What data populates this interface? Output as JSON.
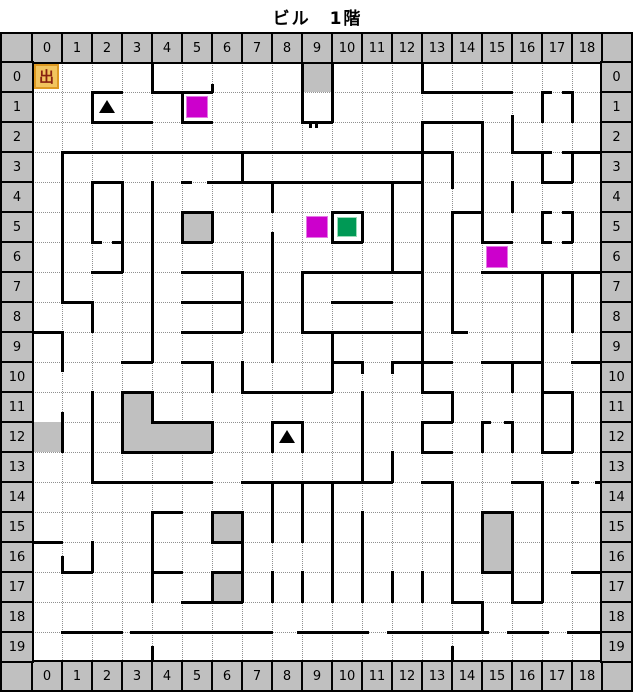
{
  "title": "ビル　1階",
  "grid": {
    "cols": 19,
    "rows": 20,
    "cell": 30,
    "origin_x": 32,
    "origin_y": 62,
    "header_w": 32,
    "right_header_w": 31,
    "header_h": 30,
    "top_labels": [
      "0",
      "1",
      "2",
      "3",
      "4",
      "5",
      "6",
      "7",
      "8",
      "9",
      "10",
      "11",
      "12",
      "13",
      "14",
      "15",
      "16",
      "17",
      "18"
    ],
    "bottom_labels": [
      "0",
      "1",
      "2",
      "3",
      "4",
      "5",
      "6",
      "7",
      "8",
      "9",
      "10",
      "11",
      "12",
      "13",
      "14",
      "15",
      "16",
      "17",
      "18"
    ],
    "left_labels": [
      "0",
      "1",
      "2",
      "3",
      "4",
      "5",
      "6",
      "7",
      "8",
      "9",
      "10",
      "11",
      "12",
      "13",
      "14",
      "15",
      "16",
      "17",
      "18",
      "19"
    ],
    "right_labels": [
      "0",
      "1",
      "2",
      "3",
      "4",
      "5",
      "6",
      "7",
      "8",
      "9",
      "10",
      "11",
      "12",
      "13",
      "14",
      "15",
      "16",
      "17",
      "18",
      "19"
    ]
  },
  "colors": {
    "header_bg": "#c0c0c0",
    "wall": "#000000",
    "grid_dot": "#909090",
    "gray_cell": "#c0c0c0",
    "magenta": "#cc00cc",
    "green": "#009955",
    "exit_bg": "#f2c45e",
    "exit_border": "#dd9922",
    "exit_text": "#882211",
    "triangle": "#000000"
  },
  "walls": {
    "h": [
      [
        0,
        0,
        19
      ],
      [
        20,
        0,
        19
      ],
      [
        1,
        2,
        3
      ],
      [
        1,
        4,
        6
      ],
      [
        1,
        13,
        16
      ],
      [
        1,
        17,
        17.3
      ],
      [
        1,
        17.7,
        18
      ],
      [
        2,
        2,
        4
      ],
      [
        2,
        5,
        6
      ],
      [
        2,
        9,
        10
      ],
      [
        2,
        13,
        15
      ],
      [
        3,
        1,
        14
      ],
      [
        3,
        16,
        17.3
      ],
      [
        3,
        17.7,
        19
      ],
      [
        4,
        2,
        3
      ],
      [
        4,
        5,
        5.3
      ],
      [
        4,
        5.85,
        13
      ],
      [
        4,
        17,
        18
      ],
      [
        5,
        5,
        6
      ],
      [
        5,
        10,
        11
      ],
      [
        5,
        14,
        15
      ],
      [
        5,
        17,
        17.3
      ],
      [
        5,
        17.7,
        18
      ],
      [
        6,
        2,
        2.3
      ],
      [
        6,
        2.7,
        3
      ],
      [
        6,
        5,
        6
      ],
      [
        6,
        10,
        11
      ],
      [
        6,
        15,
        16
      ],
      [
        6,
        17,
        17.3
      ],
      [
        6,
        17.7,
        18
      ],
      [
        7,
        2,
        3
      ],
      [
        7,
        5,
        7
      ],
      [
        7,
        9,
        13
      ],
      [
        7,
        15,
        19
      ],
      [
        8,
        1,
        2
      ],
      [
        8,
        5,
        7
      ],
      [
        8,
        10,
        12
      ],
      [
        9,
        0,
        1
      ],
      [
        9,
        5,
        7
      ],
      [
        9,
        9,
        13
      ],
      [
        9,
        14,
        14.5
      ],
      [
        10,
        3,
        4
      ],
      [
        10,
        5,
        6
      ],
      [
        10,
        10,
        11
      ],
      [
        10,
        12,
        14
      ],
      [
        10,
        15,
        17
      ],
      [
        10,
        18,
        19
      ],
      [
        11,
        3,
        4
      ],
      [
        11,
        7,
        10
      ],
      [
        11,
        13,
        14
      ],
      [
        11,
        17,
        18
      ],
      [
        12,
        4,
        6
      ],
      [
        12,
        8,
        9
      ],
      [
        12,
        13,
        14
      ],
      [
        12,
        15,
        15.25
      ],
      [
        12,
        15.75,
        16
      ],
      [
        13,
        3,
        6
      ],
      [
        13,
        13,
        14
      ],
      [
        13,
        17,
        18
      ],
      [
        14,
        2,
        6
      ],
      [
        14,
        7,
        12
      ],
      [
        14,
        13,
        14
      ],
      [
        14,
        16,
        17
      ],
      [
        14,
        18,
        18.2
      ],
      [
        14,
        18.8,
        19
      ],
      [
        15,
        4,
        5
      ],
      [
        15,
        6,
        7
      ],
      [
        15,
        15,
        16
      ],
      [
        16,
        0,
        1
      ],
      [
        16,
        6,
        7
      ],
      [
        17,
        1,
        2
      ],
      [
        17,
        4,
        5
      ],
      [
        17,
        6,
        7
      ],
      [
        17,
        15,
        16
      ],
      [
        17,
        18,
        19
      ],
      [
        18,
        5,
        7
      ],
      [
        18,
        14,
        15
      ],
      [
        18,
        16,
        17
      ],
      [
        19,
        1,
        3
      ],
      [
        19,
        3.3,
        8
      ],
      [
        19,
        8.85,
        11.2
      ],
      [
        19,
        11.85,
        15.2
      ],
      [
        19,
        15.85,
        17.2
      ],
      [
        19,
        17.85,
        19
      ]
    ],
    "v": [
      [
        0,
        0,
        20
      ],
      [
        19,
        0,
        20
      ],
      [
        1,
        3,
        8
      ],
      [
        1,
        9,
        10.3
      ],
      [
        1,
        11.7,
        13
      ],
      [
        1,
        16.5,
        17
      ],
      [
        2,
        1,
        2
      ],
      [
        2,
        4,
        6
      ],
      [
        2,
        8,
        9
      ],
      [
        2,
        11,
        14
      ],
      [
        2,
        16,
        17
      ],
      [
        3,
        4,
        7
      ],
      [
        3,
        11,
        13
      ],
      [
        4,
        0,
        1
      ],
      [
        4,
        4,
        10
      ],
      [
        4,
        11,
        12
      ],
      [
        4,
        15,
        18
      ],
      [
        4,
        19.5,
        20
      ],
      [
        5,
        1,
        2
      ],
      [
        5,
        5,
        6
      ],
      [
        6,
        0.75,
        1
      ],
      [
        6,
        5,
        6
      ],
      [
        6,
        10,
        11
      ],
      [
        6,
        12,
        13
      ],
      [
        6,
        15,
        16
      ],
      [
        6,
        17,
        18
      ],
      [
        7,
        3,
        4
      ],
      [
        7,
        7,
        9
      ],
      [
        7,
        10,
        11
      ],
      [
        7,
        15,
        18
      ],
      [
        8,
        4,
        5
      ],
      [
        8,
        5.7,
        10
      ],
      [
        8,
        12,
        13
      ],
      [
        8,
        14,
        16
      ],
      [
        8,
        17,
        18
      ],
      [
        9,
        0,
        2
      ],
      [
        9,
        7,
        9
      ],
      [
        9,
        12,
        13
      ],
      [
        9,
        14,
        16
      ],
      [
        9,
        17,
        18
      ],
      [
        10,
        0,
        2
      ],
      [
        10,
        5,
        6
      ],
      [
        10,
        9,
        11
      ],
      [
        10,
        14,
        18
      ],
      [
        11,
        5,
        6
      ],
      [
        11,
        10,
        10.35
      ],
      [
        11,
        11,
        14
      ],
      [
        11,
        15,
        18
      ],
      [
        12,
        4,
        7
      ],
      [
        12,
        10,
        10.35
      ],
      [
        12,
        13,
        14
      ],
      [
        12,
        17,
        18
      ],
      [
        13,
        0,
        1
      ],
      [
        13,
        2,
        11
      ],
      [
        13,
        12,
        13
      ],
      [
        13,
        17,
        18
      ],
      [
        14,
        3,
        4.2
      ],
      [
        14,
        5,
        9
      ],
      [
        14,
        11,
        12
      ],
      [
        14,
        14,
        18
      ],
      [
        14,
        19.5,
        20
      ],
      [
        15,
        2,
        6
      ],
      [
        15,
        12,
        13
      ],
      [
        15,
        15,
        17
      ],
      [
        15,
        18,
        19
      ],
      [
        16,
        1.8,
        3
      ],
      [
        16,
        4,
        5
      ],
      [
        16,
        10,
        11
      ],
      [
        16,
        12,
        13
      ],
      [
        16,
        15,
        18
      ],
      [
        17,
        1,
        2
      ],
      [
        17,
        3,
        4
      ],
      [
        17,
        5,
        6
      ],
      [
        17,
        7,
        13
      ],
      [
        17,
        14,
        18
      ],
      [
        18,
        1,
        2
      ],
      [
        18,
        3,
        4
      ],
      [
        18,
        5,
        6
      ],
      [
        18,
        7,
        9
      ],
      [
        18,
        11,
        13
      ]
    ]
  },
  "gray_cells": [
    {
      "col": 9,
      "row": 0
    },
    {
      "col": 5,
      "row": 5
    },
    {
      "col": 0,
      "row": 12
    },
    {
      "col": 3,
      "row": 11
    },
    {
      "col": 3,
      "row": 12
    },
    {
      "col": 4,
      "row": 12
    },
    {
      "col": 5,
      "row": 12
    },
    {
      "col": 6,
      "row": 15
    },
    {
      "col": 6,
      "row": 17
    },
    {
      "col": 15,
      "row": 15
    },
    {
      "col": 15,
      "row": 16
    }
  ],
  "items": {
    "magenta": [
      {
        "col": 5,
        "row": 1
      },
      {
        "col": 9,
        "row": 5
      },
      {
        "col": 15,
        "row": 6
      }
    ],
    "green": [
      {
        "col": 10,
        "row": 5
      }
    ],
    "triangles": [
      {
        "col": 2,
        "row": 1
      },
      {
        "col": 8,
        "row": 12
      }
    ],
    "exit": {
      "col": 0,
      "row": 0,
      "label": "出"
    }
  },
  "door_ticks": [
    {
      "x": 309,
      "y": 122
    },
    {
      "x": 315,
      "y": 122
    }
  ]
}
